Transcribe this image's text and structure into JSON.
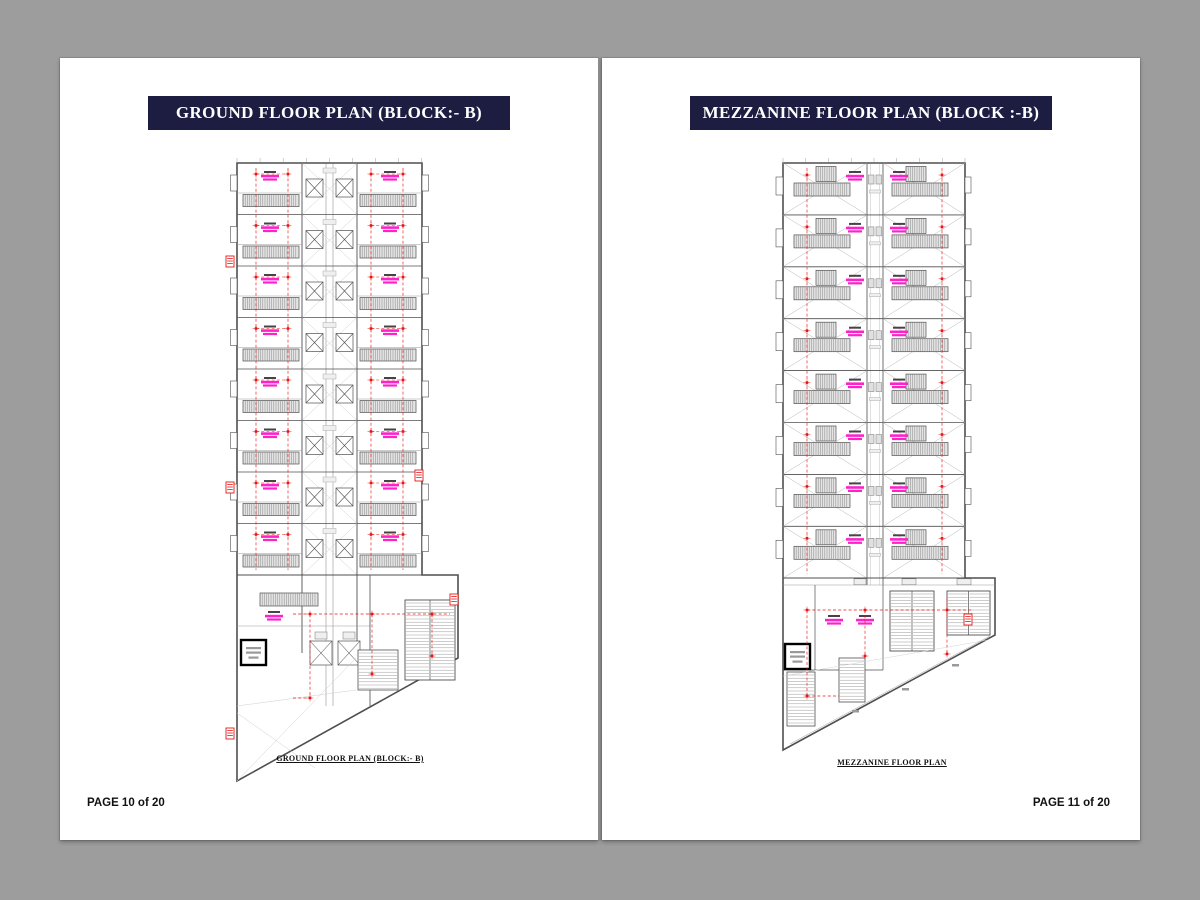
{
  "window": {
    "background": "#9d9d9d"
  },
  "pages": {
    "left": {
      "banner": "GROUND FLOOR PLAN (BLOCK:- B)",
      "caption": "GROUND FLOOR PLAN (BLOCK:- B)",
      "page_label": "PAGE 10 of 20"
    },
    "right": {
      "banner": "MEZZANINE FLOOR PLAN (BLOCK :-B)",
      "caption": "MEZZANINE FLOOR PLAN",
      "page_label": "PAGE 11 of 20"
    }
  },
  "colors": {
    "banner_bg": "#1d1d42",
    "banner_text": "#ffffff",
    "page_bg": "#ffffff",
    "wall": "#4f4f4f",
    "line_light": "#9a9a9a",
    "hatch_bg": "#e4e4e4",
    "hatch_line": "#7d7d7d",
    "label_magenta": "#ff22cc",
    "label_black": "#444444",
    "red": "#e81616"
  },
  "plan_config": {
    "left_units": 8,
    "right_units": 8
  }
}
